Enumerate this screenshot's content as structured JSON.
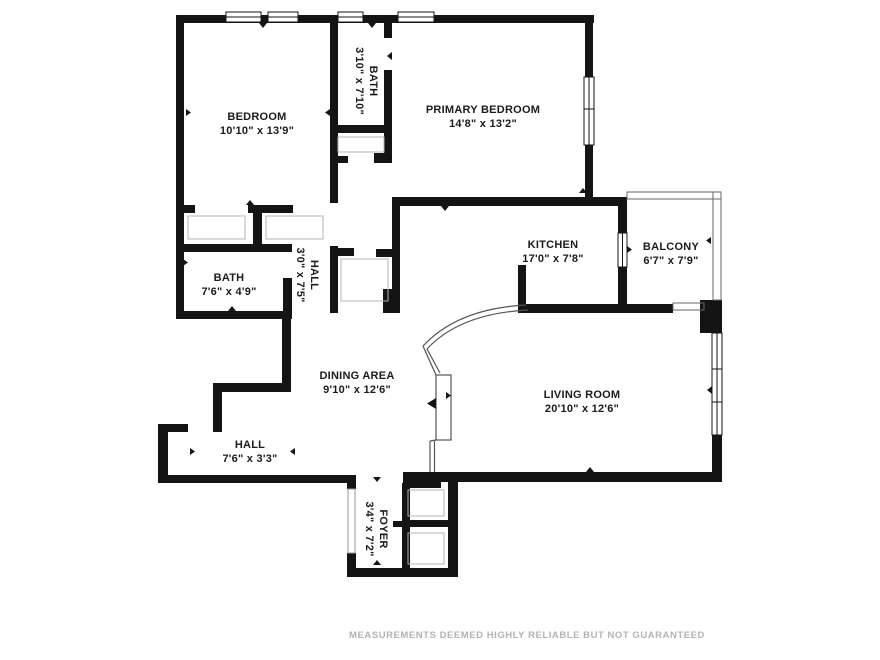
{
  "rooms": [
    {
      "name": "BEDROOM",
      "dims": "10'10\" x 13'9\""
    },
    {
      "name": "BATH",
      "dims": "3'10\" x 7'10\""
    },
    {
      "name": "PRIMARY BEDROOM",
      "dims": "14'8\" x 13'2\""
    },
    {
      "name": "KITCHEN",
      "dims": "17'0\" x 7'8\""
    },
    {
      "name": "BALCONY",
      "dims": "6'7\" x 7'9\""
    },
    {
      "name": "BATH",
      "dims": "7'6\" x 4'9\""
    },
    {
      "name": "HALL",
      "dims": "3'0\" x 7'5\""
    },
    {
      "name": "DINING AREA",
      "dims": "9'10\" x 12'6\""
    },
    {
      "name": "LIVING ROOM",
      "dims": "20'10\" x 12'6\""
    },
    {
      "name": "HALL",
      "dims": "7'6\" x 3'3\""
    },
    {
      "name": "FOYER",
      "dims": "3'4\" x 7'2\""
    }
  ],
  "footer": {
    "disclaimer": "MEASUREMENTS DEEMED HIGHLY RELIABLE BUT NOT GUARANTEED"
  },
  "colors": {
    "wall": "#141414",
    "label_text": "#1b1b1b",
    "thin_line": "#666666",
    "footer_text": "#b3b3b3"
  }
}
